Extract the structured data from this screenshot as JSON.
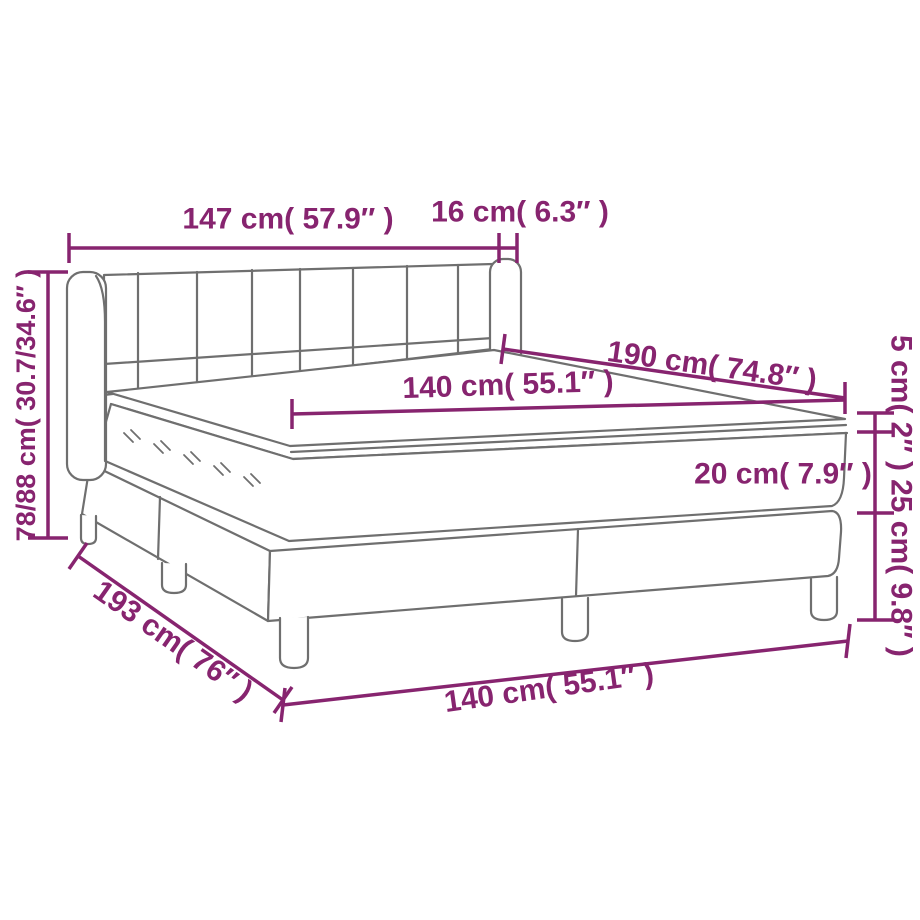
{
  "colors": {
    "accent": "#87246F",
    "line": "#6F6F6F",
    "background": "#FFFFFF"
  },
  "diagram": {
    "subject": "Box spring bed with headboard, mattress and topper — dimension drawing",
    "labels": {
      "headboard_width": "147 cm( 57.9″ )",
      "side_depth": "16 cm( 6.3″ )",
      "mattress_length": "190 cm( 74.8″ )",
      "mattress_width": "140 cm( 55.1″ )",
      "topper_thickness": "5 cm( 2″ )",
      "mattress_thickness": "20 cm( 7.9″ )",
      "base_height": "25 cm( 9.8″ )",
      "overall_height": "78/88 cm( 30.7/34.6″ )",
      "base_length": "193 cm( 76″ )",
      "base_width": "140 cm( 55.1″ )"
    }
  }
}
